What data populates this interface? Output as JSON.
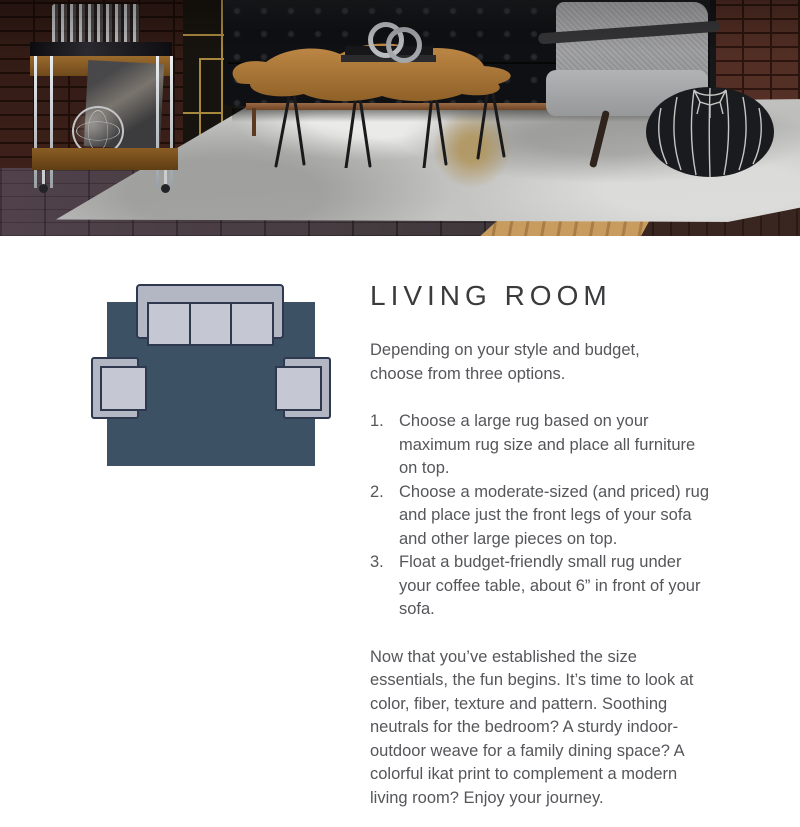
{
  "colors": {
    "heading": "#3A3B3D",
    "body": "#55565A",
    "diagram_rug": "#3C5164",
    "diagram_furniture": "#B3B7C3",
    "diagram_cushion": "#C5C8D2",
    "diagram_outline": "#2E3950"
  },
  "article": {
    "title": "LIVING ROOM",
    "intro": "Depending on your style and budget, choose from three options.",
    "steps": [
      {
        "number": "1.",
        "text": "Choose a large rug based on your maximum rug size and place all furniture on top."
      },
      {
        "number": "2.",
        "text": "Choose a moderate-sized (and priced) rug and place just the front legs of your sofa and other large pieces on top."
      },
      {
        "number": "3.",
        "text": "Float a budget-friendly small rug under your coffee table, about 6” in front of your sofa."
      }
    ],
    "outro": "Now that you’ve established the size essentials, the fun begins. It’s time to look at color, fiber, texture and pattern. Soothing neutrals for the bedroom? A sturdy indoor-outdoor weave for a family dining space? A colorful ikat print to complement a modern living room? Enjoy your journey."
  }
}
